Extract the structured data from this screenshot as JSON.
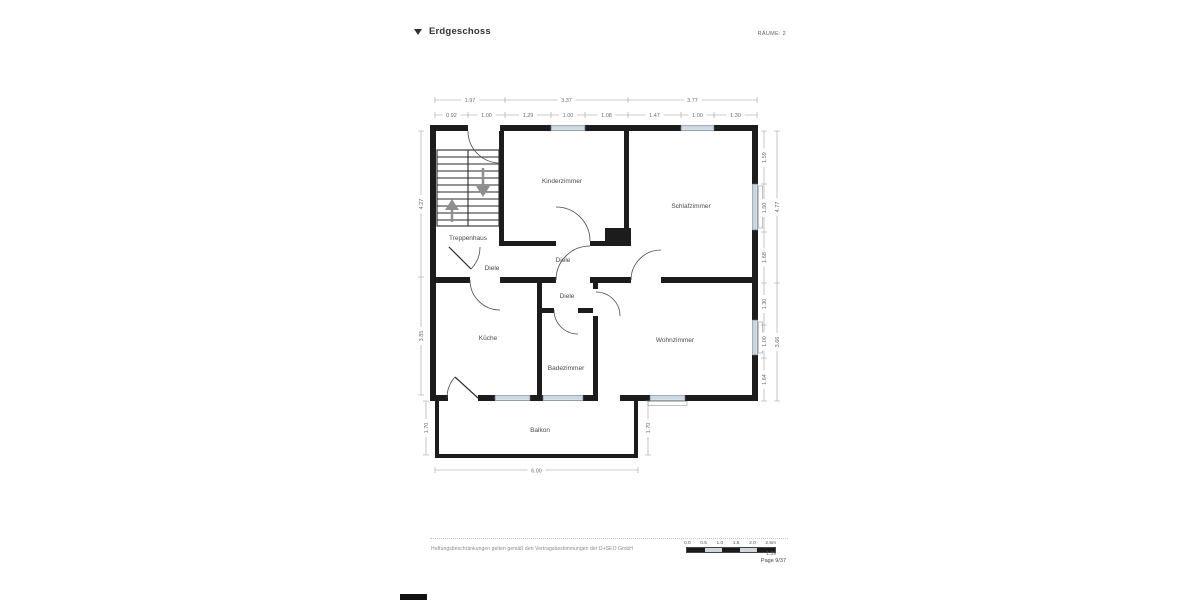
{
  "header": {
    "collapse_icon": "collapsed-triangle",
    "title": "Erdgeschoss",
    "rooms_label": "RÄUME: 2"
  },
  "floorplan": {
    "rooms": {
      "treppenhaus": "Treppenhaus",
      "kinderzimmer": "Kinderzimmer",
      "schlafzimmer": "Schlafzimmer",
      "diele_upper": "Diele",
      "diele_left": "Diele",
      "diele_lower": "Diele",
      "kueche": "Küche",
      "badezimmer": "Badezimmer",
      "wohnzimmer": "Wohnzimmer",
      "balkon": "Balkon"
    },
    "dims": {
      "top_row1": [
        "1.97",
        "3.37",
        "3.77"
      ],
      "top_row2": [
        "0.92",
        "1.00",
        "1.29",
        "1.00",
        "1.08",
        "1.47",
        "1.00",
        "1.30"
      ],
      "left": [
        "4.27",
        "3.85"
      ],
      "right_inner": [
        "1.59",
        "1.50",
        "1.68",
        "1.30",
        "1.00",
        "1.64"
      ],
      "right_outer": [
        "4.77",
        "3.66"
      ],
      "balcony_left": "1.70",
      "balcony_right": "1.70",
      "balcony_bottom": "6.00"
    },
    "colors": {
      "wall": "#1c1c1c",
      "window_fill": "#dfe9f1",
      "dim_line": "#999999",
      "stair_arrow": "#8e8e8e"
    }
  },
  "footer": {
    "disclaimer": "Haftungsbeschränkungen gelten gemäß den Vertragsbestimmungen der D+SEO GmbH",
    "scale_ticks": [
      "0.0",
      "0.5",
      "1.0",
      "1.5",
      "2.0",
      "2.5m"
    ],
    "scale_ratio": "1:59",
    "page_label": "Page 9/37"
  }
}
